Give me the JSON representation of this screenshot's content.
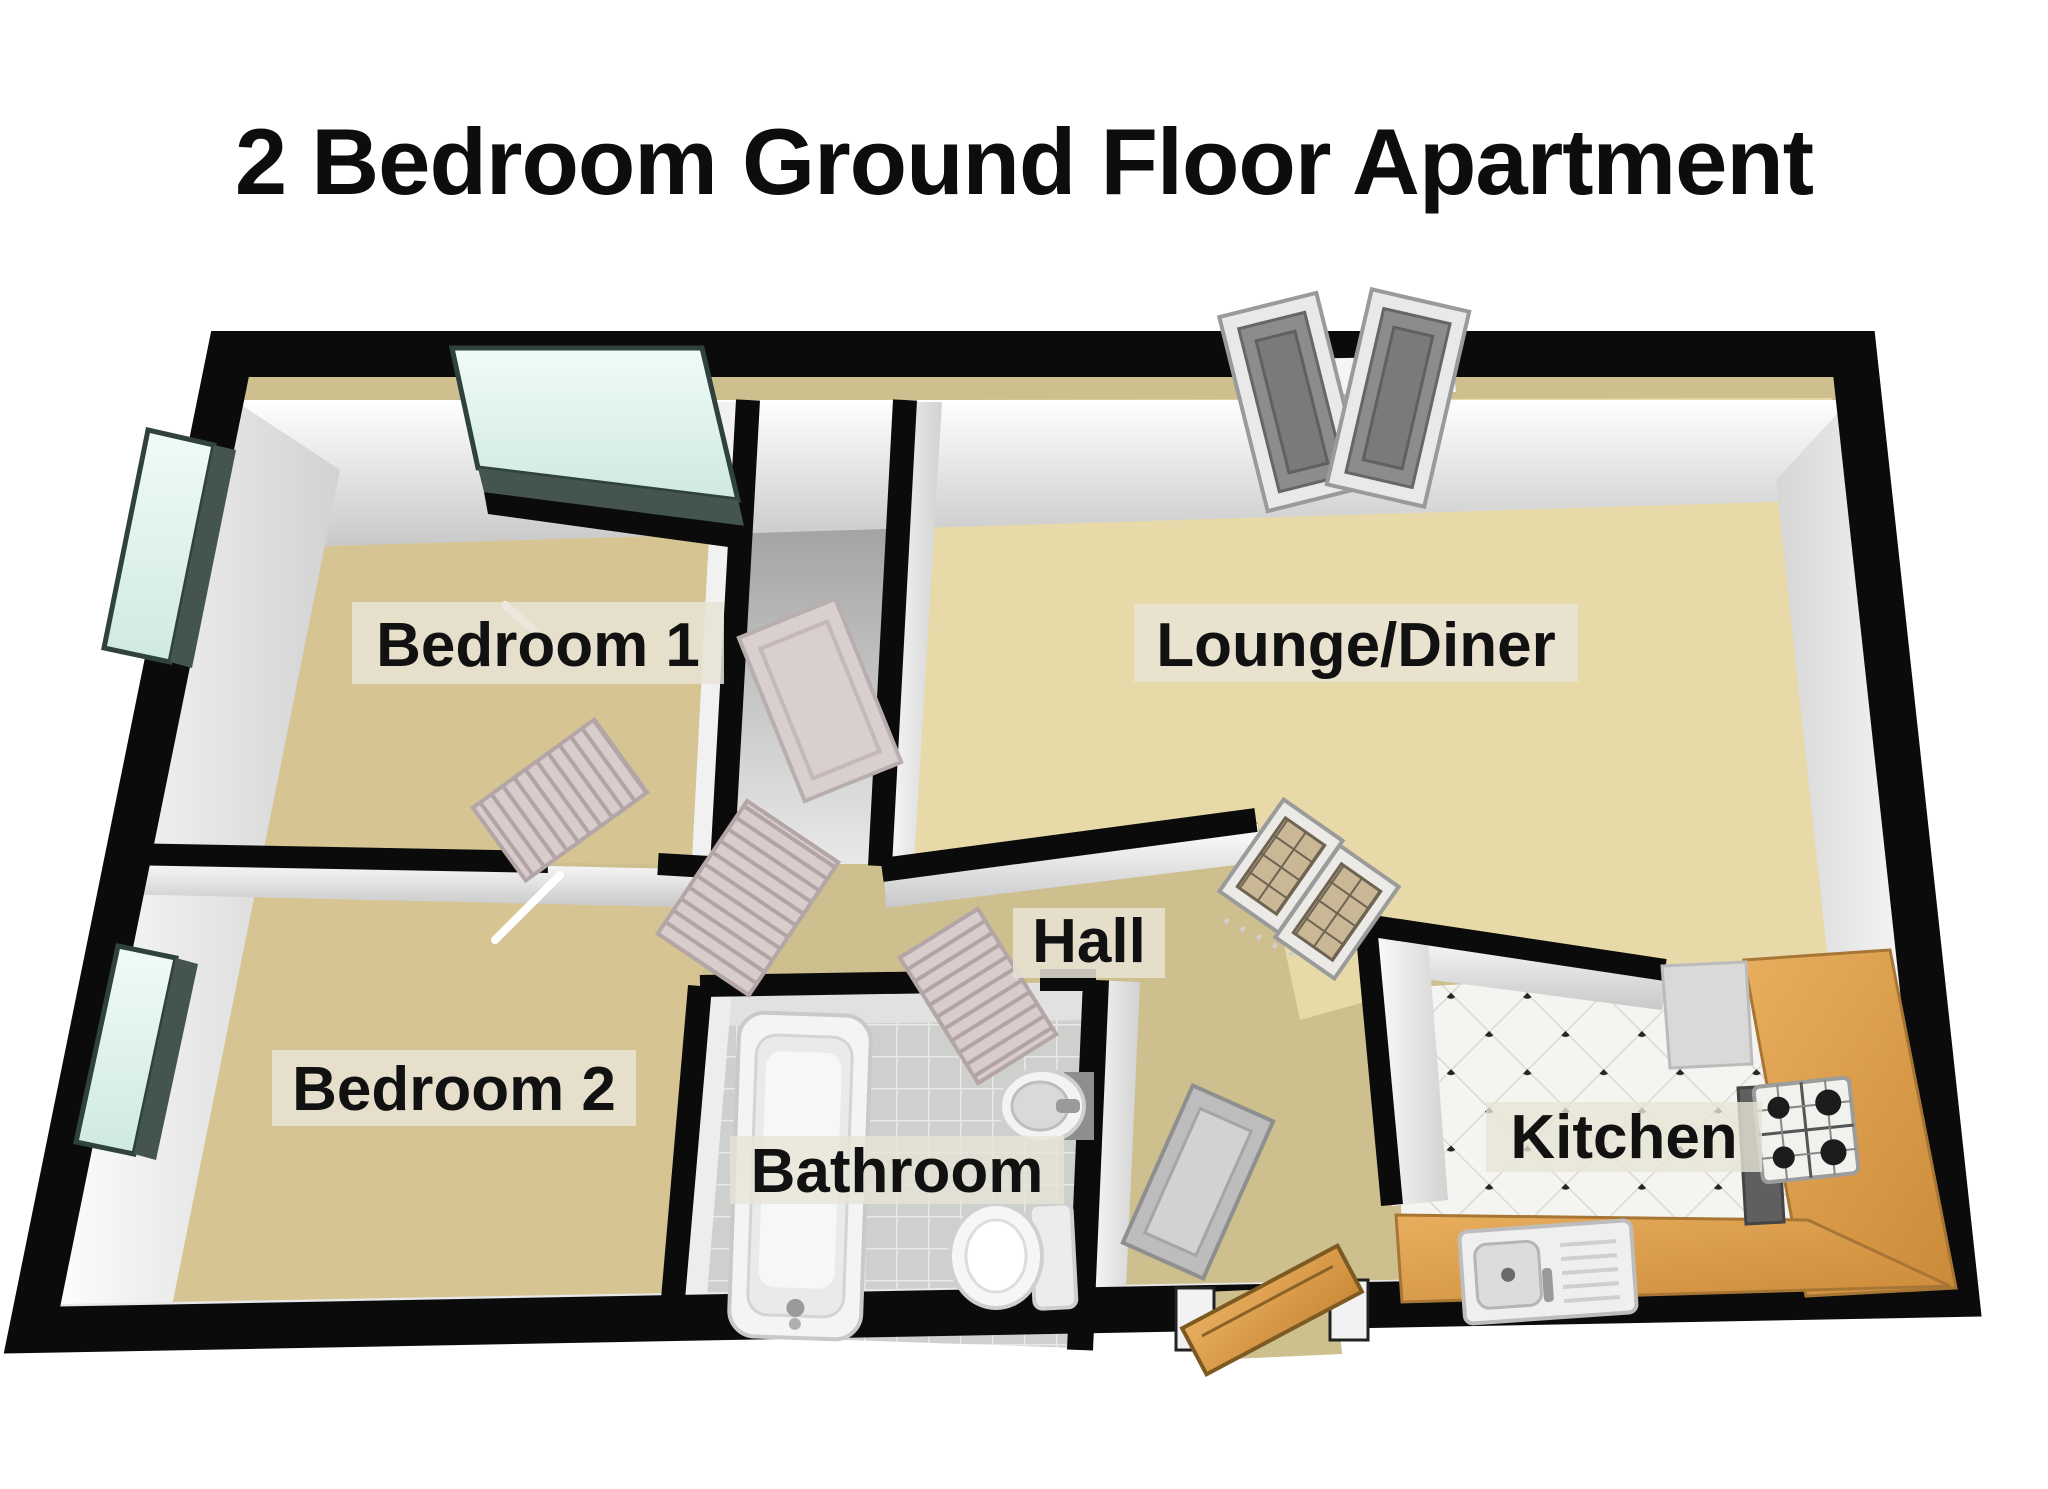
{
  "title": "2 Bedroom Ground Floor Apartment",
  "rooms": {
    "bedroom1": {
      "label": "Bedroom 1"
    },
    "lounge": {
      "label": "Lounge/Diner"
    },
    "hall": {
      "label": "Hall"
    },
    "bedroom2": {
      "label": "Bedroom 2"
    },
    "bathroom": {
      "label": "Bathroom"
    },
    "kitchen": {
      "label": "Kitchen"
    }
  },
  "palette": {
    "wall_black": "#0b0b0b",
    "carpet_tan": "#d6c593",
    "carpet_sand": "#e7d9a8",
    "hall_floor": "#cdbf8e",
    "window_glass": "#e3f6f1",
    "window_sill": "#44554f",
    "counter_wood": "#dda052",
    "appliance_gray": "#d9d9d9",
    "oven_gray": "#5f5f5f",
    "door_panel": "#d8cccc",
    "door_gray": "#bdbdbd",
    "front_door_wood": "#c08a3e",
    "fixture_white": "#f4f4f4",
    "label_bg": "#e7e3d6",
    "label_text": "#111111"
  }
}
